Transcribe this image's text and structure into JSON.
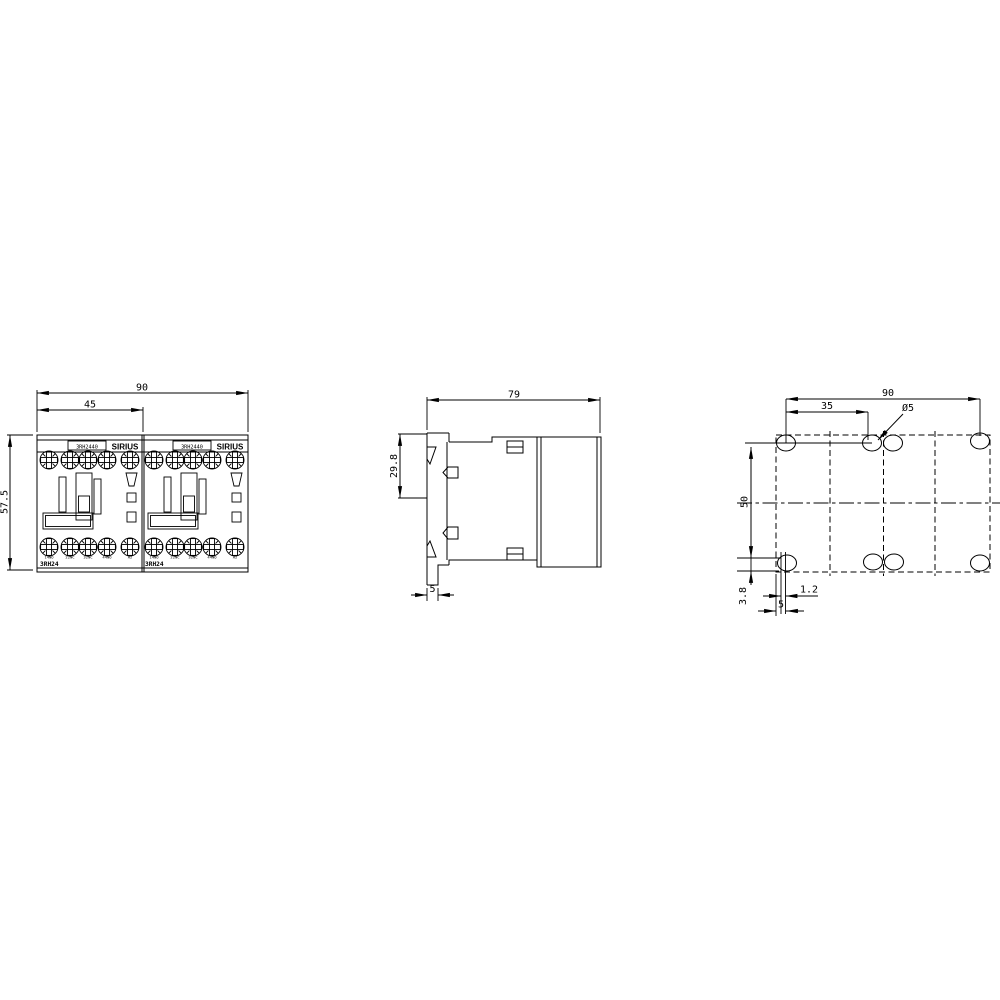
{
  "drawing": {
    "front": {
      "dim_total_width": "90",
      "dim_module_width": "45",
      "dim_height": "57.5",
      "module": {
        "order_number": "3RH2440",
        "brand": "SIRIUS",
        "series_label": "3RH24",
        "terminals": [
          "14NO",
          "22NC",
          "32NC",
          "44NO",
          "A2"
        ]
      }
    },
    "side": {
      "dim_depth": "79",
      "dim_rail_height": "29.8",
      "dim_foot_width": "5"
    },
    "drill_plan": {
      "dim_total_width": "90",
      "dim_hole_pitch": "35",
      "hole_diameter": "Ø5",
      "dim_vertical_pitch": "50",
      "dim_slot_offset": "3.8",
      "dim_slot_width": "1.2",
      "dim_edge_offset": "5"
    },
    "line_color": "#000000",
    "background": "#ffffff"
  }
}
